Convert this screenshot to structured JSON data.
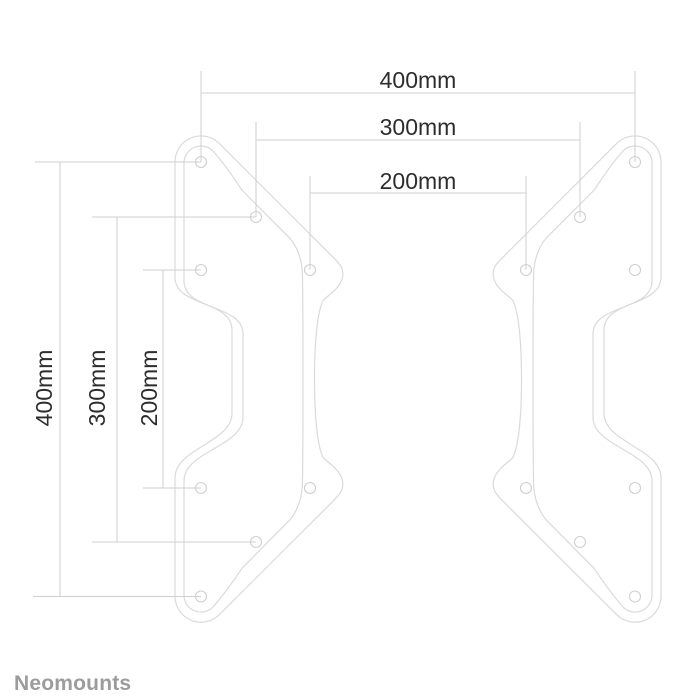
{
  "drawing": {
    "type": "technical-dimension-drawing",
    "subject": "vesa-adapter-plates",
    "plates": {
      "count": 2,
      "holes_per_plate": 8
    },
    "horizontal_dimensions": [
      {
        "label": "400mm",
        "value_mm": 400
      },
      {
        "label": "300mm",
        "value_mm": 300
      },
      {
        "label": "200mm",
        "value_mm": 200
      }
    ],
    "vertical_dimensions": [
      {
        "label": "400mm",
        "value_mm": 400
      },
      {
        "label": "300mm",
        "value_mm": 300
      },
      {
        "label": "200mm",
        "value_mm": 200
      }
    ],
    "logo_text": "Neomounts",
    "colors": {
      "background": "#ffffff",
      "plate_outline": "#dadada",
      "dimension_lines": "#cfcfcf",
      "label_text": "#2d2d2d",
      "logo_text": "#9c9c9c"
    }
  }
}
